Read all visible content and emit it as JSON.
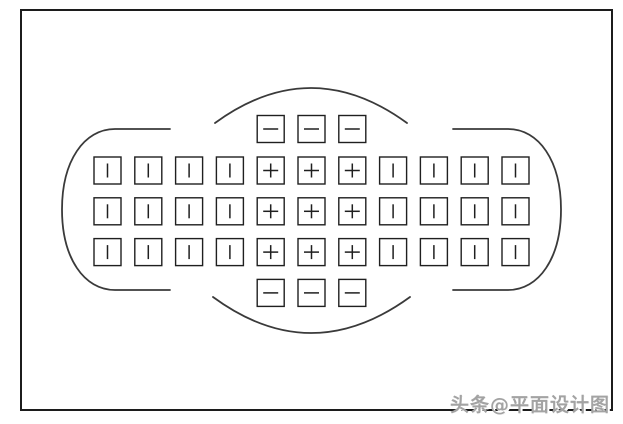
{
  "page": {
    "background": "#ffffff",
    "width": 623,
    "height": 424
  },
  "watermark": {
    "text": "头条@平面设计图",
    "color": "#a3a3a3"
  },
  "diagram": {
    "description": "camera-viewfinder-39-autofocus-point-layout",
    "border": {
      "x": 21,
      "y": 10,
      "width": 591,
      "height": 400,
      "color": "#1c1c1c",
      "stroke_width": 2
    },
    "outline": {
      "color": "#3a3a3a",
      "stroke_width": 1.8,
      "paths": {
        "top-arc": "M 215 123 Q 311 53 407 123",
        "bottom-arc": "M 213 297 Q 311 369 410 297",
        "left-bracket": "M 170 129 L 115 129 C 84 129 62 161 62 209.5 C 62 258 84 290 115 290 L 170 290",
        "right-bracket": "M 453 129 L 508 129 C 539 129 561 161 561 209.5 C 561 258 539 290 508 290 L 453 290"
      }
    },
    "grid": {
      "cell_size": 27,
      "pitch": 40.8,
      "origin_x": 94,
      "col_count": 11,
      "box_color": "#1f1f1f",
      "box_stroke_width": 1.4,
      "symbol_color": "#1f1f1f",
      "symbol_stroke_width": 1.5,
      "symbol_legend": {
        "bar": "vertical-line AF point",
        "plus": "cross-type AF point",
        "minus": "horizontal-line AF point"
      },
      "rows": [
        {
          "y": 115.5,
          "start_col": 4,
          "symbols": [
            "minus",
            "minus",
            "minus"
          ]
        },
        {
          "y": 157.0,
          "start_col": 0,
          "symbols": [
            "bar",
            "bar",
            "bar",
            "bar",
            "plus",
            "plus",
            "plus",
            "bar",
            "bar",
            "bar",
            "bar"
          ]
        },
        {
          "y": 197.8,
          "start_col": 0,
          "symbols": [
            "bar",
            "bar",
            "bar",
            "bar",
            "plus",
            "plus",
            "plus",
            "bar",
            "bar",
            "bar",
            "bar"
          ]
        },
        {
          "y": 238.6,
          "start_col": 0,
          "symbols": [
            "bar",
            "bar",
            "bar",
            "bar",
            "plus",
            "plus",
            "plus",
            "bar",
            "bar",
            "bar",
            "bar"
          ]
        },
        {
          "y": 279.4,
          "start_col": 4,
          "symbols": [
            "minus",
            "minus",
            "minus"
          ]
        }
      ]
    }
  }
}
